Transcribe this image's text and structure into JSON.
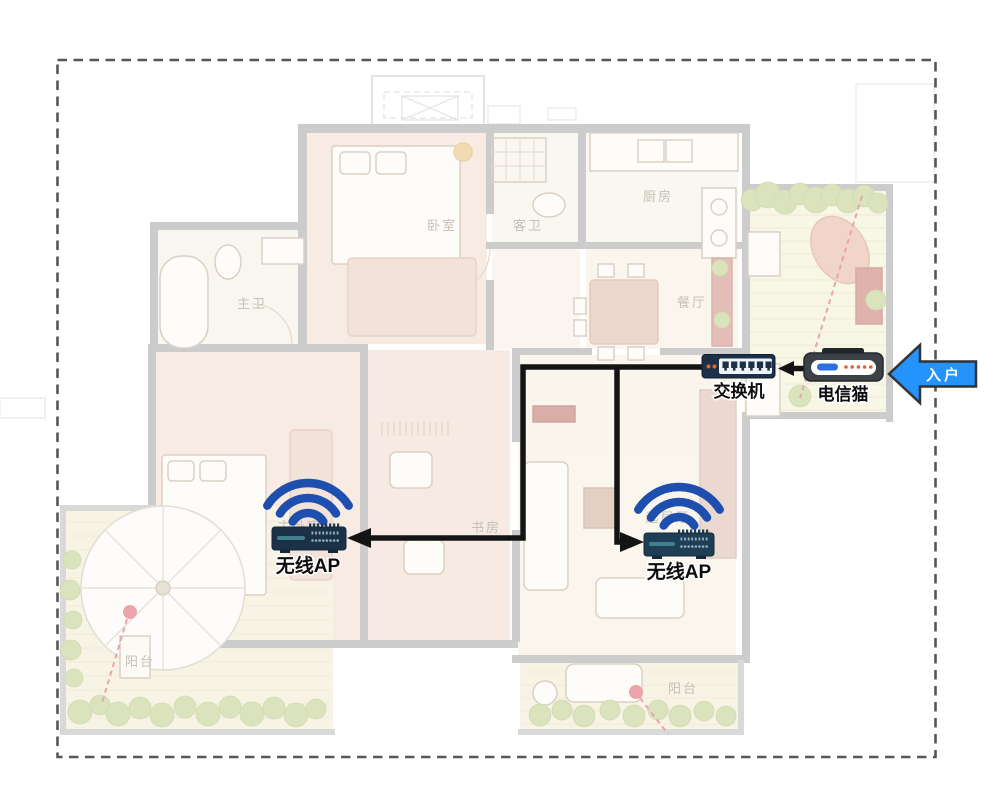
{
  "network": {
    "cable_color": "#141414",
    "wifi_color": "#1e4fae",
    "device_navy": "#1c3147",
    "modem_gray": "#3c4147",
    "led_orange": "#e4632c",
    "devices": {
      "switch": {
        "label": "交换机"
      },
      "modem": {
        "label": "电信猫"
      },
      "ap_left": {
        "label": "无线AP"
      },
      "ap_right": {
        "label": "无线AP"
      }
    },
    "entry": {
      "label": "入户",
      "arrow_color": "#2493fb",
      "arrow_outline": "#333333"
    }
  },
  "floorplan": {
    "label_color": "#8d8273",
    "marker_red": "#d84b59",
    "rooms": {
      "master_bath": "主卫",
      "guest_bath": "客卫",
      "kitchen": "厨房",
      "dining": "餐厅",
      "bedroom": "卧室",
      "master_bedroom": "主卧室",
      "study": "书房",
      "living": "起居厅",
      "balcony_left": "阳台",
      "balcony_bottom": "阳台"
    }
  }
}
